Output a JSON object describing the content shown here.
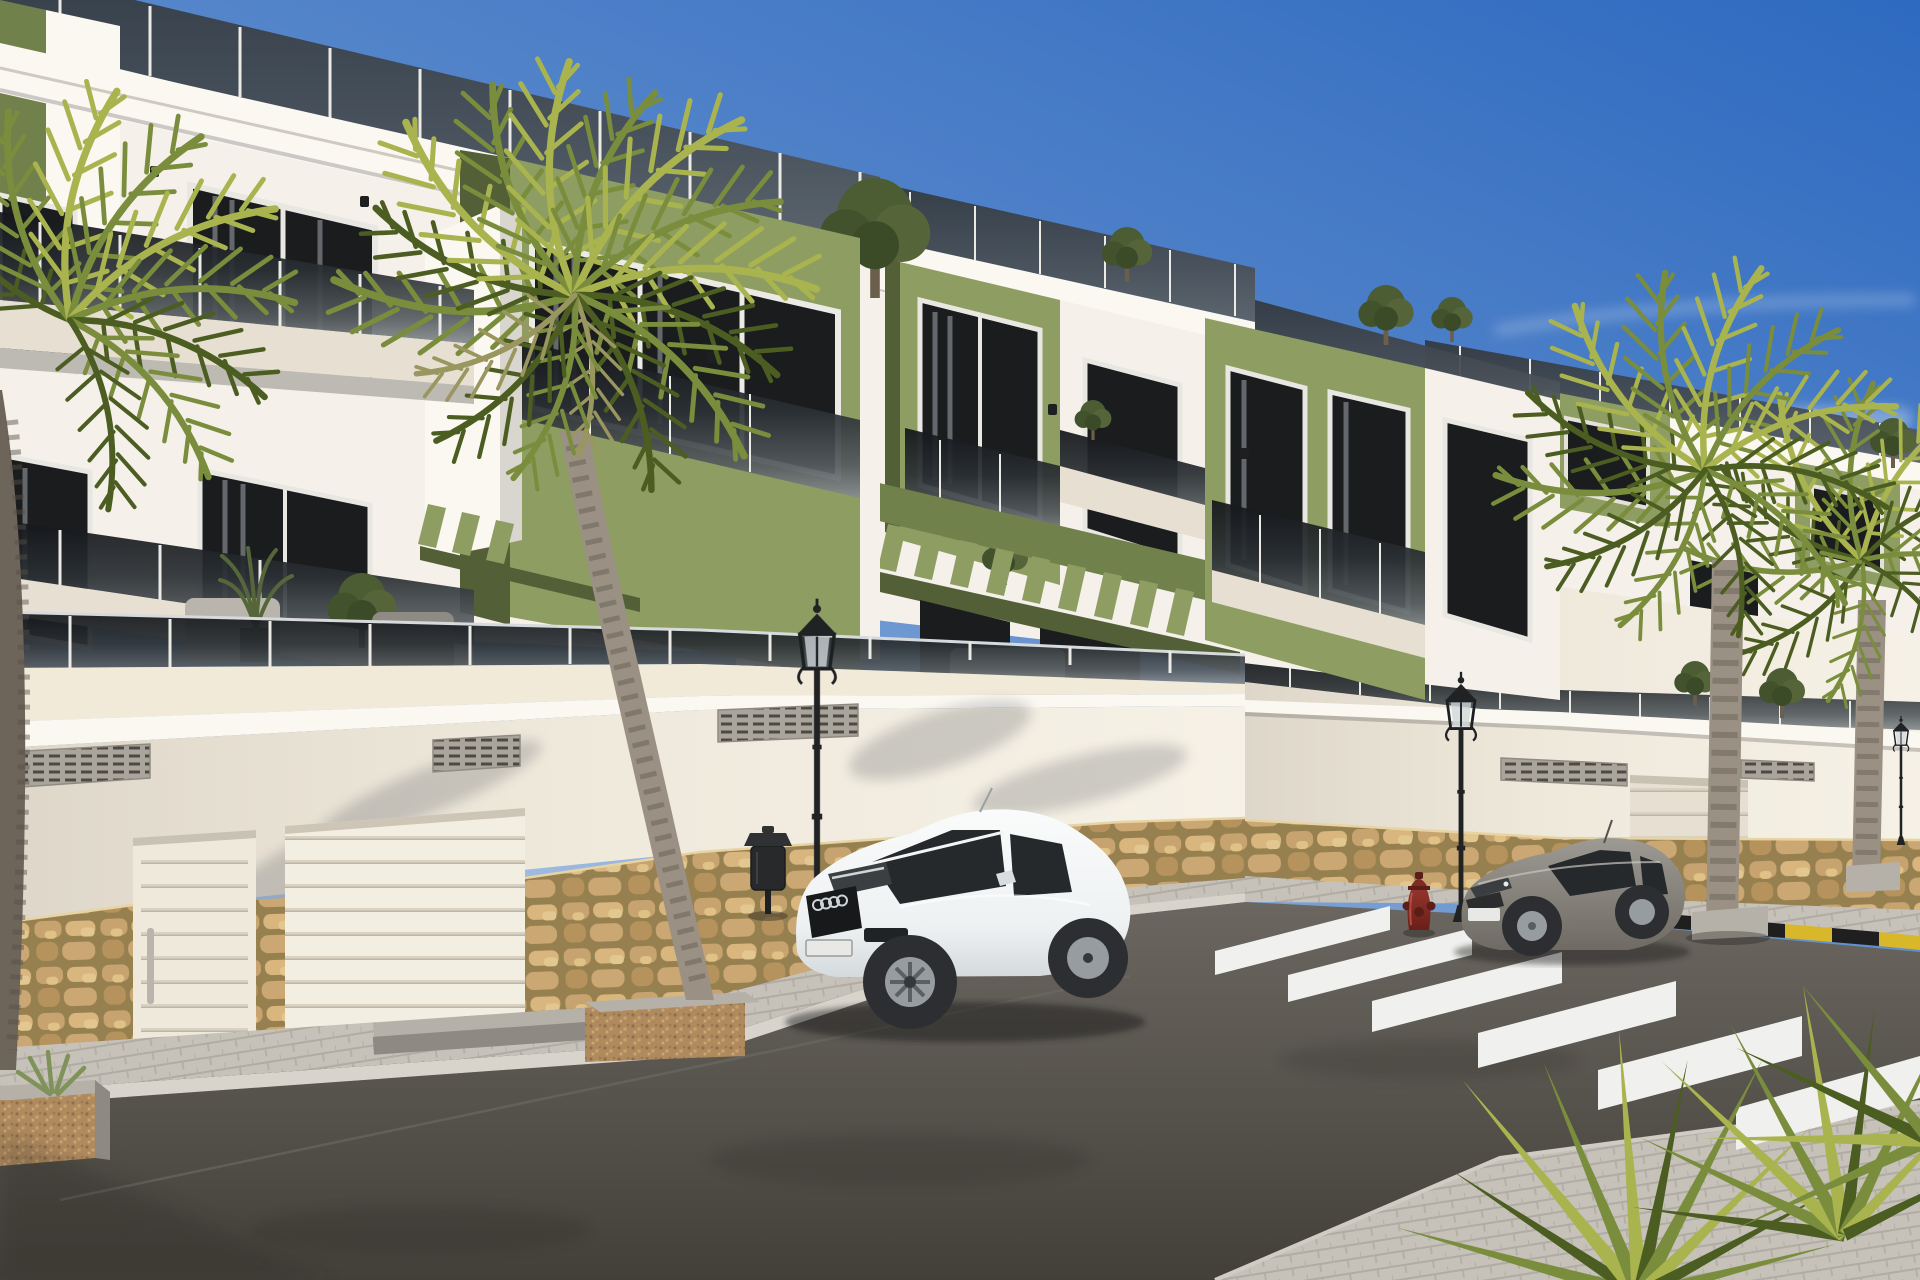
{
  "meta": {
    "type": "3d-architectural-render",
    "width_px": 1920,
    "height_px": 1280
  },
  "scene": {
    "title": "New-build apartment complex street view",
    "description": "Sunny photorealistic rendering of a modern three-storey Mediterranean apartment row with olive-green accent volumes, smoked-glass balcony balustrades, roof terraces, green louvered pergolas and street-level garages on a stone-clad podium. Palm trees line the street where a white coupe and a gray coupe are parked near ornate black lanterns, a red fire hydrant and a zebra crosswalk under a clear blue sky.",
    "time_of_day": "day",
    "weather": "clear sky with thin wispy clouds"
  },
  "palette": {
    "sky_top": "#2e6ac0",
    "sky_mid": "#5d8bcc",
    "sky_horizon": "#b6cde8",
    "white_sun": "#f5f1ea",
    "white_warm": "#f2ead9",
    "white_shade": "#d9d5cf",
    "white_shade_deep": "#bdbab3",
    "cream_slab": "#e7dfd2",
    "green_sun": "#8e9d62",
    "green_mid": "#71814b",
    "green_dark": "#525f37",
    "frame_white": "#eceae5",
    "window_dark": "#1a1c1e",
    "curtain_gray": "#777c80",
    "stone_tan": "#c2a069",
    "asphalt": "#4b4844",
    "sidewalk": "#c9c5bd",
    "curb_light": "#d8d4cc",
    "curb_yellow": "#d9b72b",
    "curb_black": "#1f1f1f",
    "stripe_white": "#f0f1ee",
    "lamp_black": "#212224",
    "bin_gray": "#28292b",
    "hydrant_red": "#7e2b24",
    "hydrant_dark": "#5a1d18",
    "car_white": "#f4f5f6",
    "car_glass": "#26292c",
    "wheel_dark": "#2c2e31",
    "rim_silver": "#979ca0",
    "car_gray": "#8f8b84",
    "plate_white": "#e8e9e6",
    "palm_trunk": "#9a9083",
    "palm_trunk_dark": "#6e655a",
    "frond_light": "#a9b44f",
    "frond_mid": "#7a8d3c",
    "frond_dark": "#4c5d22",
    "frond_dry": "#9a9660"
  },
  "objects": {
    "buildings": {
      "count": 3,
      "storeys": 3,
      "style": "modern Mediterranean new-build",
      "accent": "olive-green volumes",
      "features": [
        "roof terraces with smoked glass railings",
        "balconies with dark glass balustrades",
        "green louvered pergolas",
        "street-level garages",
        "stone wainscot podium",
        "white crown mouldings"
      ]
    },
    "vehicles": [
      {
        "name": "white-coupe",
        "description": "white sports coupe parked at left curb"
      },
      {
        "name": "gray-coupe",
        "description": "gray coupe parked near the crosswalk"
      }
    ],
    "street_lamps": {
      "count": 3,
      "style": "ornate black lantern post"
    },
    "palm_trees": {
      "count": 4
    },
    "yucca_clusters": {
      "count": 2
    },
    "crosswalk": {
      "stripe_count": 6
    },
    "garage_doors": {
      "count": 3
    },
    "pedestrian_doors": {
      "count": 1
    },
    "fire_hydrant": {
      "count": 1
    },
    "litter_bin": {
      "count": 1
    },
    "planters": {
      "count": 3
    },
    "rooftop_shrubs": {
      "count": 5
    }
  }
}
